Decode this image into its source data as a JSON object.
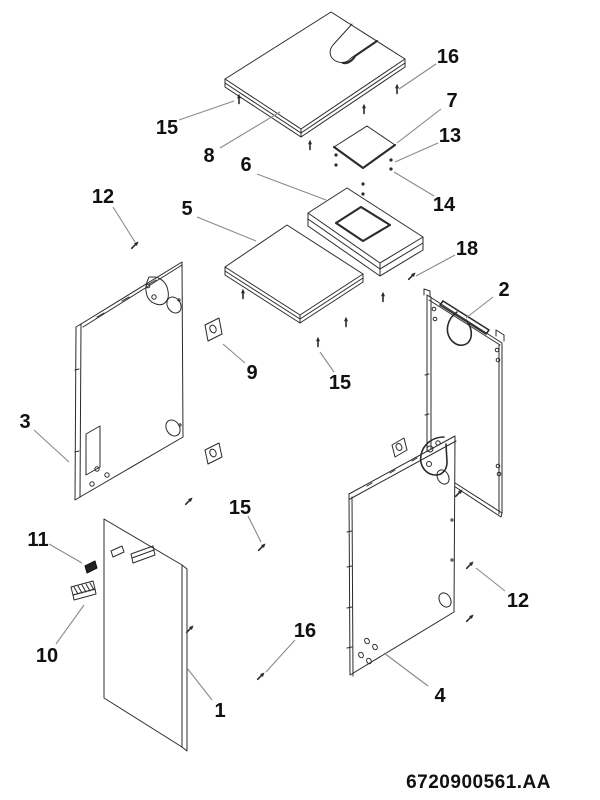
{
  "page": {
    "background": "#ffffff",
    "line_color": "#2b2b2b",
    "leader_color": "#8a8a8a",
    "text_color": "#111111"
  },
  "drawing": {
    "document_number": "6720900561.AA",
    "callouts": [
      {
        "label": "16",
        "tx": 448,
        "ty": 56,
        "x1": 436,
        "y1": 64,
        "x2": 399,
        "y2": 89
      },
      {
        "label": "7",
        "tx": 452,
        "ty": 100,
        "x1": 441,
        "y1": 109,
        "x2": 397,
        "y2": 143
      },
      {
        "label": "13",
        "tx": 450,
        "ty": 135,
        "x1": 438,
        "y1": 143,
        "x2": 395,
        "y2": 162
      },
      {
        "label": "14",
        "tx": 444,
        "ty": 204,
        "x1": 434,
        "y1": 196,
        "x2": 394,
        "y2": 172
      },
      {
        "label": "18",
        "tx": 467,
        "ty": 248,
        "x1": 455,
        "y1": 255,
        "x2": 416,
        "y2": 276
      },
      {
        "label": "2",
        "tx": 504,
        "ty": 289,
        "x1": 493,
        "y1": 297,
        "x2": 466,
        "y2": 318
      },
      {
        "label": "12",
        "tx": 103,
        "ty": 196,
        "x1": 113,
        "y1": 207,
        "x2": 135,
        "y2": 242
      },
      {
        "label": "15",
        "tx": 167,
        "ty": 127,
        "x1": 179,
        "y1": 120,
        "x2": 234,
        "y2": 101
      },
      {
        "label": "8",
        "tx": 209,
        "ty": 155,
        "x1": 220,
        "y1": 148,
        "x2": 280,
        "y2": 112
      },
      {
        "label": "6",
        "tx": 246,
        "ty": 164,
        "x1": 257,
        "y1": 174,
        "x2": 326,
        "y2": 200
      },
      {
        "label": "5",
        "tx": 187,
        "ty": 208,
        "x1": 197,
        "y1": 217,
        "x2": 256,
        "y2": 241
      },
      {
        "label": "9",
        "tx": 252,
        "ty": 372,
        "x1": 245,
        "y1": 363,
        "x2": 223,
        "y2": 344
      },
      {
        "label": "15",
        "tx": 340,
        "ty": 382,
        "x1": 334,
        "y1": 372,
        "x2": 320,
        "y2": 352
      },
      {
        "label": "15",
        "tx": 240,
        "ty": 507,
        "x1": 248,
        "y1": 516,
        "x2": 261,
        "y2": 542
      },
      {
        "label": "16",
        "tx": 305,
        "ty": 630,
        "x1": 295,
        "y1": 640,
        "x2": 266,
        "y2": 672
      },
      {
        "label": "1",
        "tx": 220,
        "ty": 710,
        "x1": 212,
        "y1": 700,
        "x2": 187,
        "y2": 668
      },
      {
        "label": "3",
        "tx": 25,
        "ty": 421,
        "x1": 34,
        "y1": 430,
        "x2": 69,
        "y2": 462
      },
      {
        "label": "11",
        "tx": 38,
        "ty": 539,
        "x1": 49,
        "y1": 544,
        "x2": 82,
        "y2": 563
      },
      {
        "label": "10",
        "tx": 47,
        "ty": 655,
        "x1": 56,
        "y1": 644,
        "x2": 84,
        "y2": 605
      },
      {
        "label": "4",
        "tx": 440,
        "ty": 695,
        "x1": 428,
        "y1": 686,
        "x2": 384,
        "y2": 653
      },
      {
        "label": "12",
        "tx": 518,
        "ty": 600,
        "x1": 505,
        "y1": 591,
        "x2": 476,
        "y2": 568
      }
    ],
    "screws": [
      {
        "x": 239,
        "y": 96,
        "t": "v"
      },
      {
        "x": 364,
        "y": 106,
        "t": "v"
      },
      {
        "x": 397,
        "y": 86,
        "t": "v"
      },
      {
        "x": 310,
        "y": 142,
        "t": "v"
      },
      {
        "x": 243,
        "y": 291,
        "t": "v"
      },
      {
        "x": 383,
        "y": 294,
        "t": "v"
      },
      {
        "x": 346,
        "y": 319,
        "t": "v"
      },
      {
        "x": 318,
        "y": 339,
        "t": "v"
      },
      {
        "x": 191,
        "y": 499,
        "t": "d"
      },
      {
        "x": 264,
        "y": 545,
        "t": "d"
      },
      {
        "x": 192,
        "y": 627,
        "t": "d"
      },
      {
        "x": 263,
        "y": 674,
        "t": "d"
      },
      {
        "x": 414,
        "y": 274,
        "t": "d"
      },
      {
        "x": 472,
        "y": 563,
        "t": "d"
      },
      {
        "x": 472,
        "y": 616,
        "t": "d"
      },
      {
        "x": 461,
        "y": 491,
        "t": "d"
      },
      {
        "x": 137,
        "y": 243,
        "t": "d"
      }
    ],
    "dots": [
      [
        391,
        160
      ],
      [
        391,
        169
      ],
      [
        336,
        155
      ],
      [
        336,
        165
      ],
      [
        363,
        184
      ],
      [
        363,
        194
      ]
    ]
  }
}
